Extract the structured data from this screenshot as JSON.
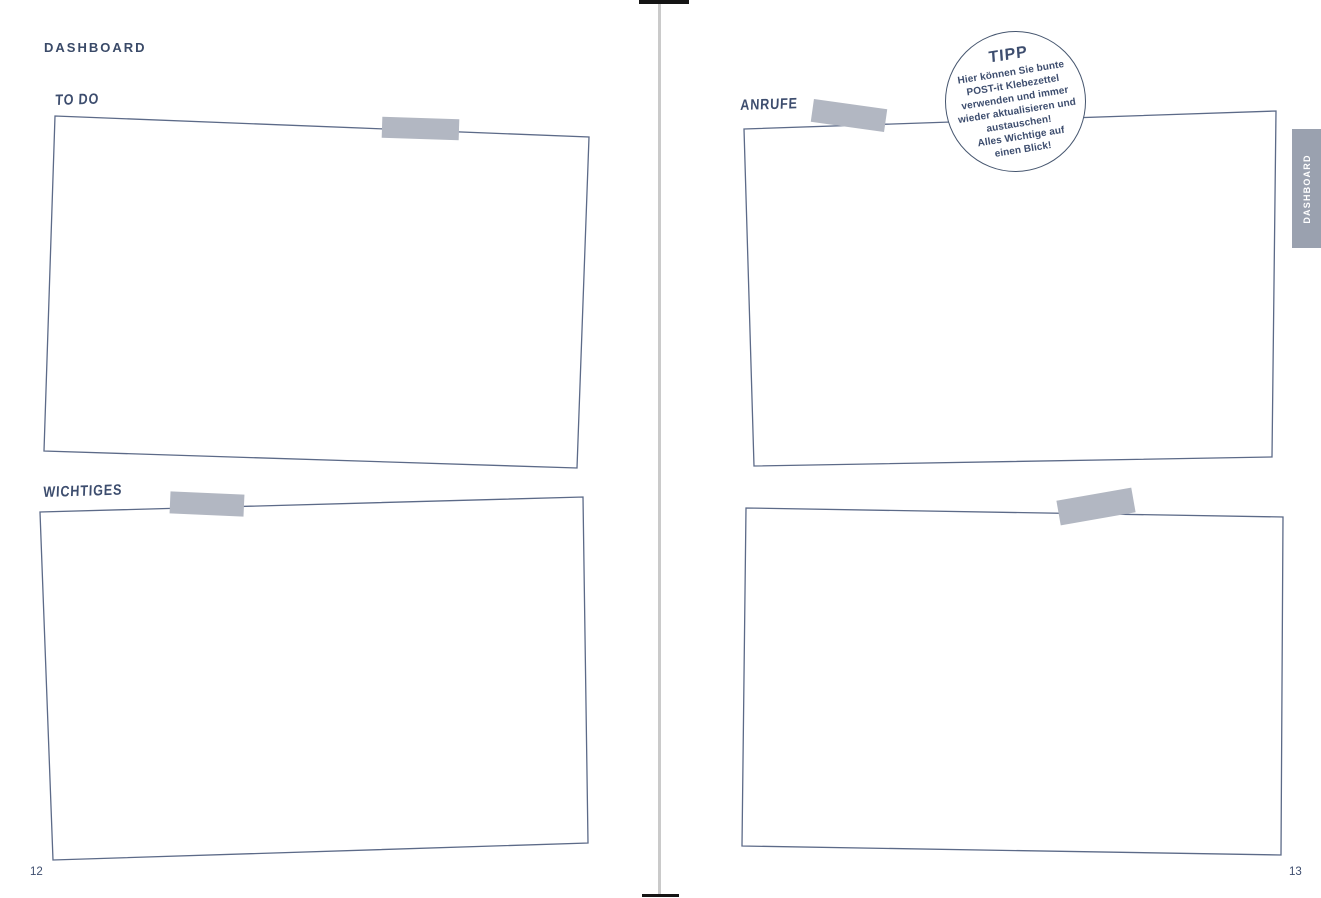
{
  "header": {
    "title": "DASHBOARD"
  },
  "side_tab": {
    "label": "DASHBOARD"
  },
  "pages": {
    "left_number": "12",
    "right_number": "13"
  },
  "sections": {
    "todo": {
      "label": "TO DO"
    },
    "wichtiges": {
      "label": "WICHTIGES"
    },
    "anrufe": {
      "label": "ANRUFE"
    }
  },
  "tip": {
    "title": "TIPP",
    "lines": [
      "Hier können Sie bunte",
      "POST-it Klebezettel",
      "verwenden und immer",
      "wieder aktualisieren und",
      "austauschen!",
      "Alles Wichtige auf",
      "einen Blick!"
    ]
  },
  "colors": {
    "ink": "#3d4d6e",
    "box_outline": "#5c6a88",
    "tape": "#b2b7c2",
    "tab_background": "#9aa1af",
    "tab_text": "#ffffff",
    "spine": "#cacaca"
  }
}
